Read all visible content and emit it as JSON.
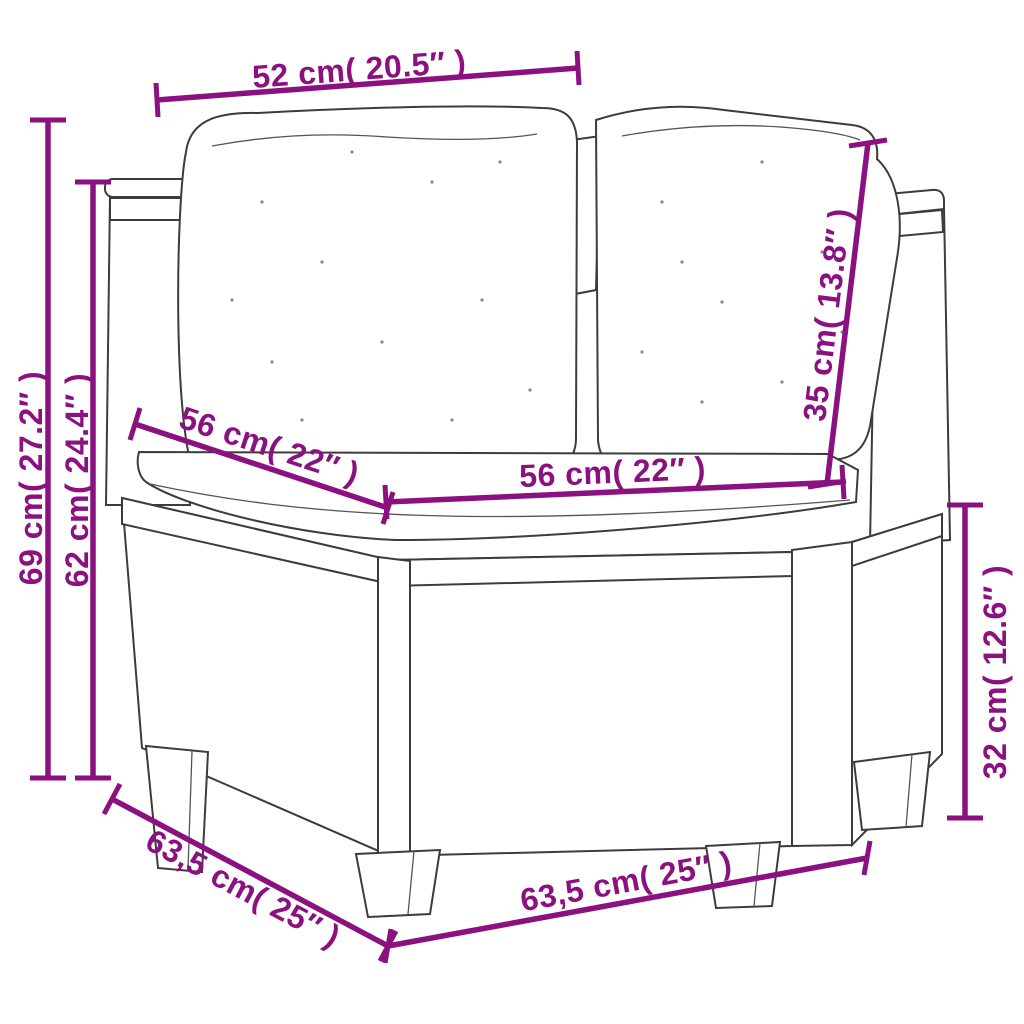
{
  "diagram": {
    "subject": "corner garden sofa with cushions - dimension drawing",
    "colors": {
      "dimension_accent": "#8A117F",
      "sketch_line": "#3C3C3C",
      "background": "#FFFFFF"
    },
    "dimensions": {
      "back_width_top": {
        "label": "52 cm( 20.5″ )"
      },
      "total_height": {
        "label": "69 cm( 27.2″ )"
      },
      "armrest_height": {
        "label": "62 cm( 24.4″ )"
      },
      "seat_depth": {
        "label": "56 cm( 22″ )"
      },
      "seat_width": {
        "label": "56 cm( 22″ )"
      },
      "back_cushion_height": {
        "label": "35 cm( 13.8″ )"
      },
      "base_height": {
        "label": "32 cm( 12.6″ )"
      },
      "total_depth": {
        "label": "63,5 cm( 25″ )"
      },
      "total_width": {
        "label": "63,5 cm( 25″ )"
      }
    }
  }
}
